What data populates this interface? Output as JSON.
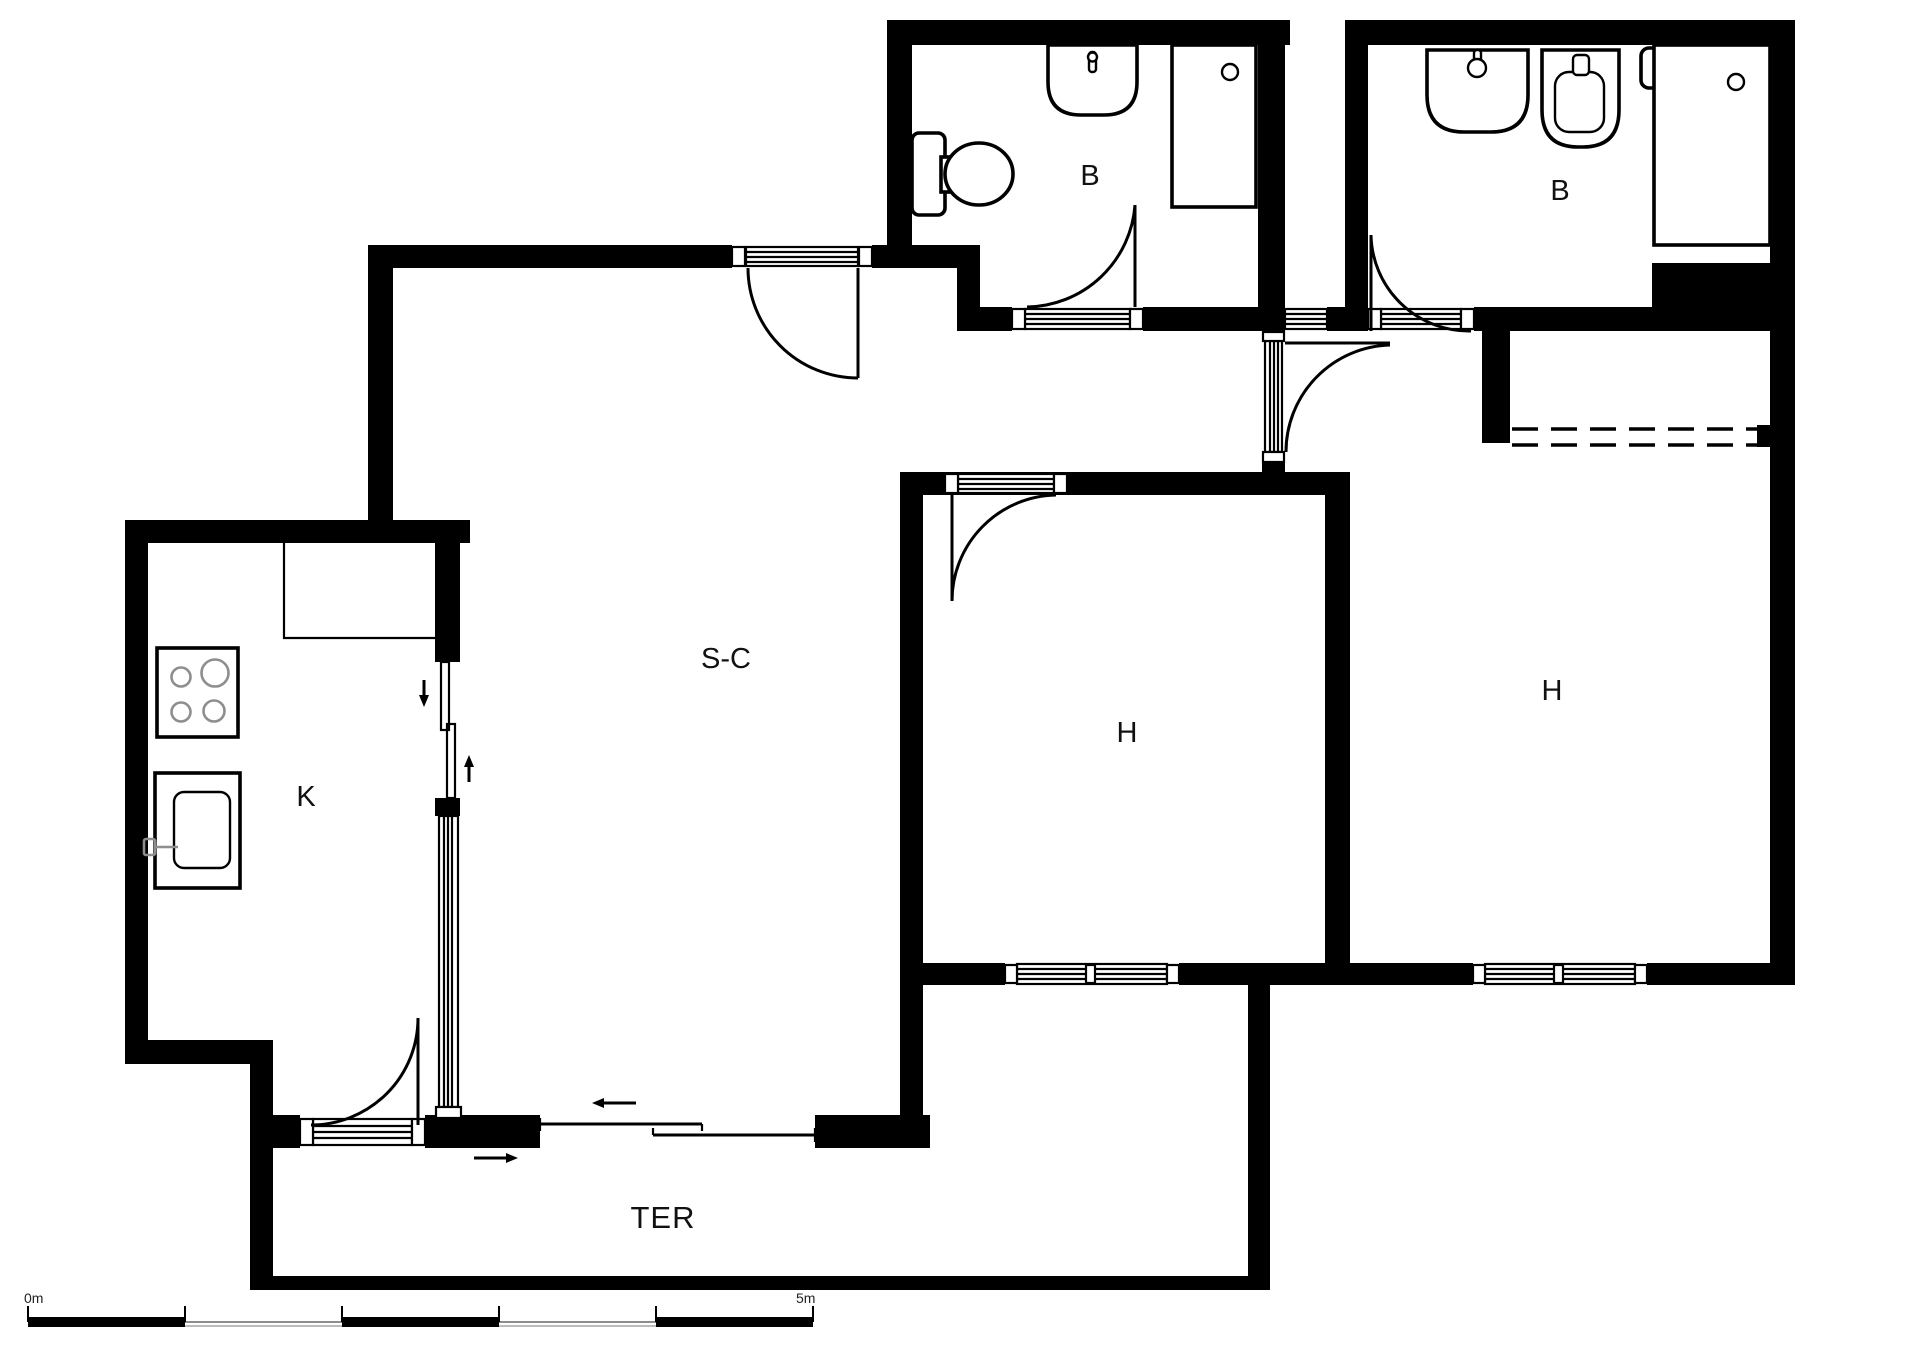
{
  "document": {
    "type": "floor-plan",
    "units_shown": "meters"
  },
  "rooms": {
    "living": {
      "label": "S-C"
    },
    "kitchen": {
      "label": "K"
    },
    "bedroom_middle": {
      "label": "H"
    },
    "bedroom_right": {
      "label": "H"
    },
    "bathroom_left": {
      "label": "B"
    },
    "bathroom_right": {
      "label": "B"
    },
    "terrace": {
      "label": "TER"
    }
  },
  "scale_bar": {
    "start_label": "0m",
    "end_label": "5m"
  },
  "colors": {
    "wall": "#000000",
    "line": "#000000",
    "background": "#ffffff",
    "detail_gray": "#8e8e8e"
  }
}
